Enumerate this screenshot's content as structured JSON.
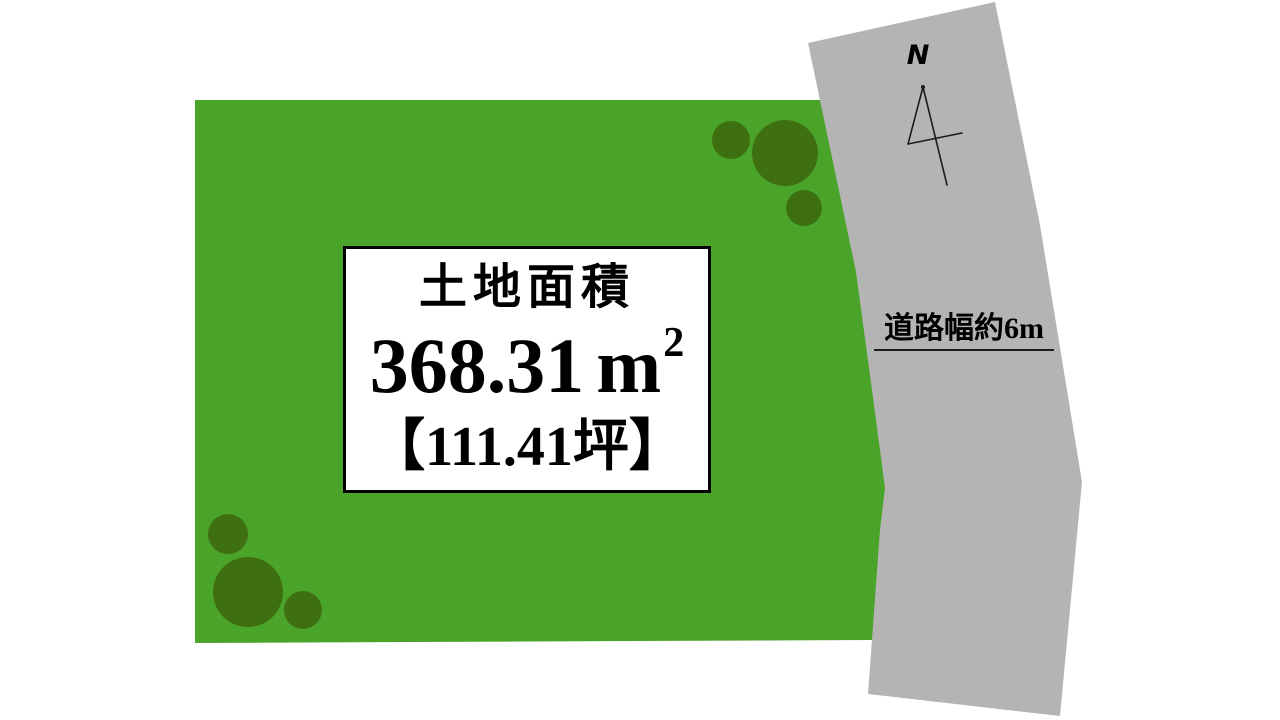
{
  "land_plot": {
    "fill_color": "#4aa42a",
    "tree_color": "#3e7011",
    "label_box": {
      "title": "土地面積",
      "area_value": "368.31",
      "area_unit": "m",
      "area_exponent": "2",
      "area_tsubo": "【111.41坪】"
    }
  },
  "road": {
    "fill_color": "#b4b4b4",
    "width_label": "道路幅約6m"
  },
  "compass": {
    "label": "N"
  }
}
